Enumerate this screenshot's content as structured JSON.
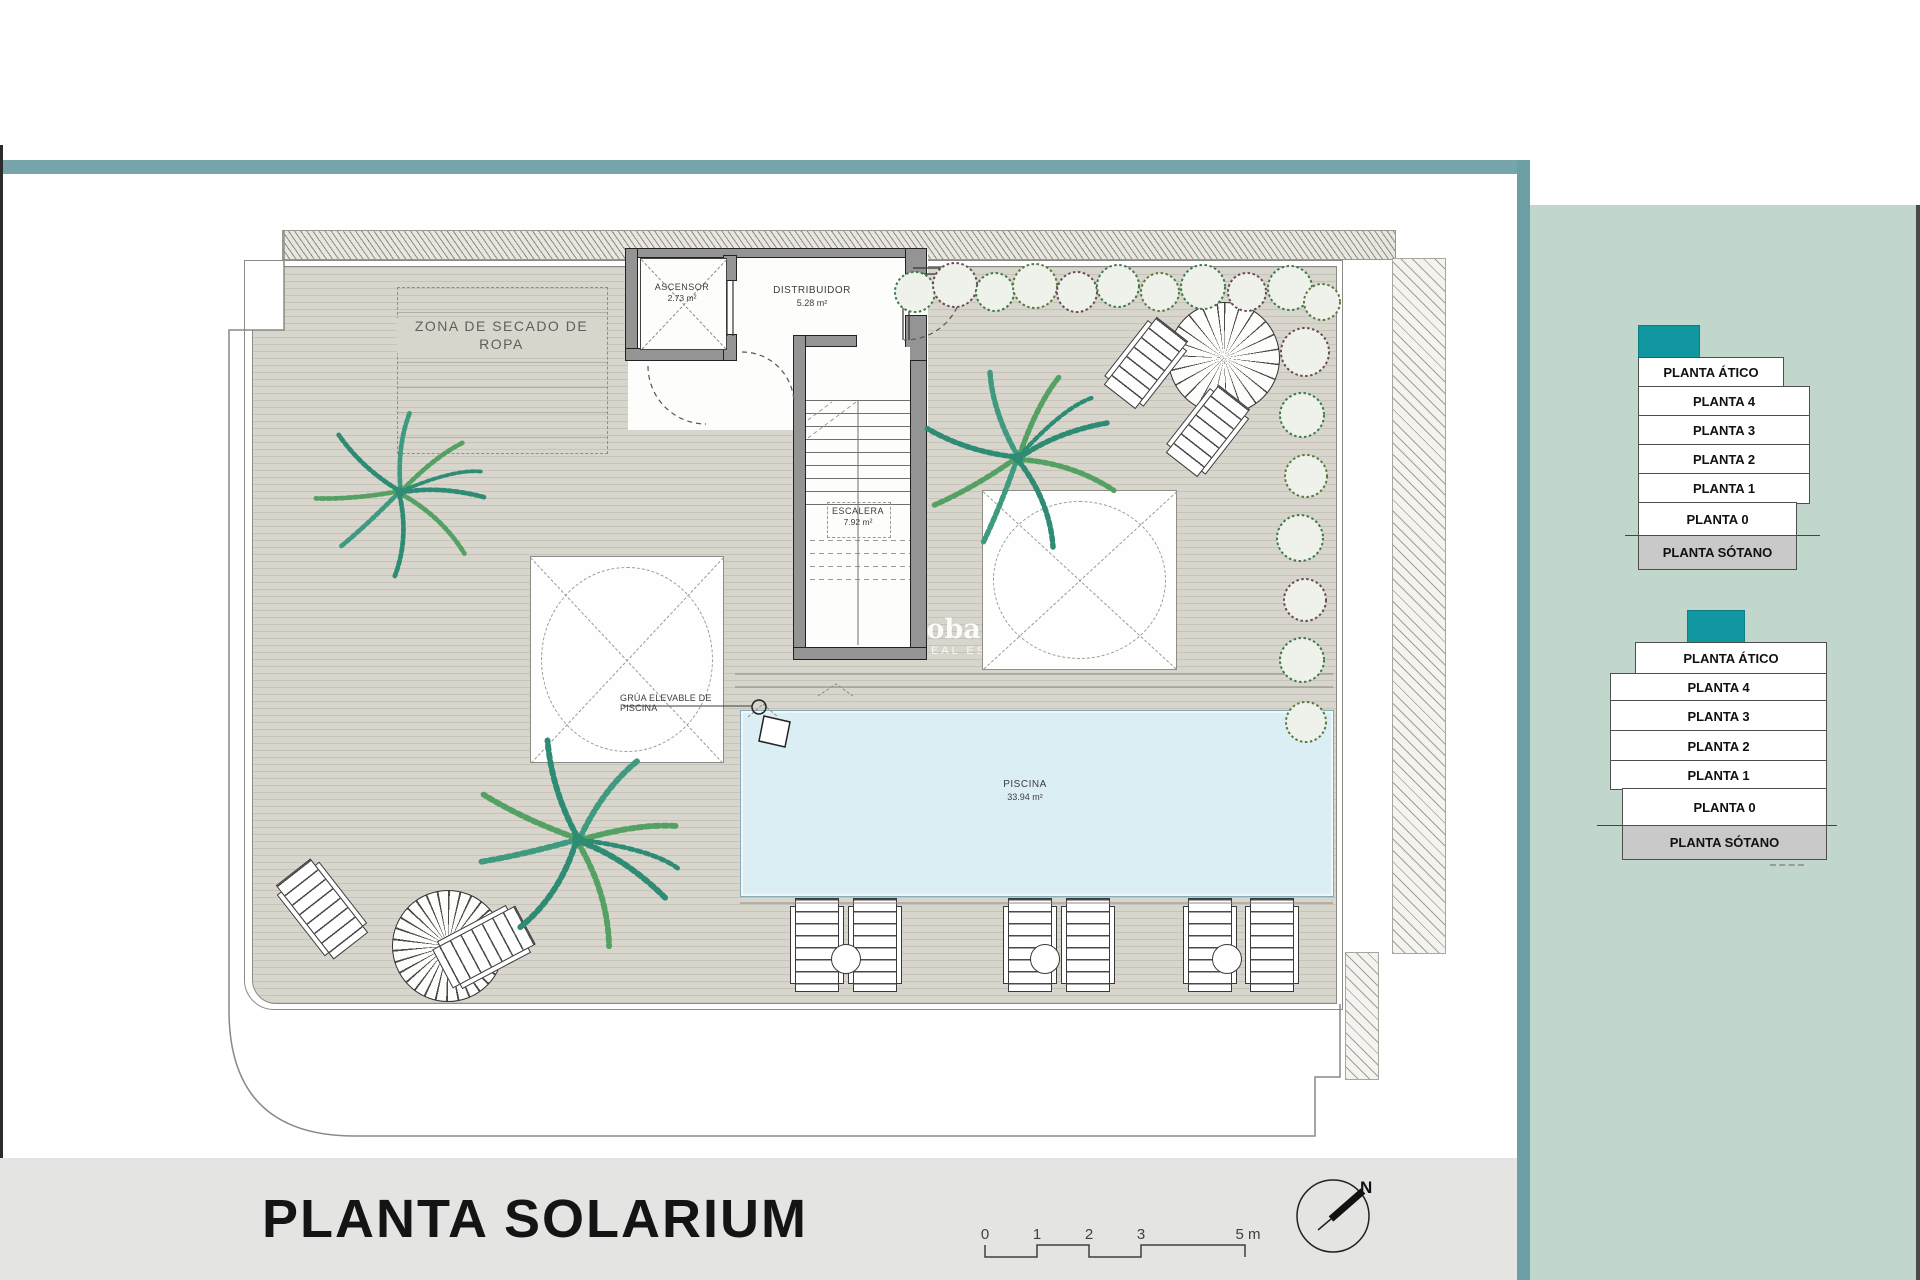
{
  "title": {
    "text": "PLANTA SOLARIUM"
  },
  "plan": {
    "rooms": {
      "ascensor": {
        "name": "ASCENSOR",
        "area": "2.73 m²"
      },
      "distribuidor": {
        "name": "DISTRIBUIDOR",
        "area": "5.28 m²"
      },
      "escalera": {
        "name": "ESCALERA",
        "area": "7.92 m²"
      },
      "piscina": {
        "name": "PISCINA",
        "area": "33.94 m²"
      }
    },
    "labels": {
      "drying_zone": "ZONA DE SECADO DE ROPA",
      "pool_lift": "GRÚA ELEVABLE DE PISCINA"
    },
    "watermark": {
      "brand": "Global S",
      "tagline": "REAL ESTAT"
    }
  },
  "scalebar": {
    "t0": "0",
    "t1": "1",
    "t2": "2",
    "t3": "3",
    "t5": "5 m"
  },
  "compass": {
    "north": "N"
  },
  "stacks": [
    {
      "levels": [
        "PLANTA ÁTICO",
        "PLANTA 4",
        "PLANTA 3",
        "PLANTA 2",
        "PLANTA 1",
        "PLANTA 0",
        "PLANTA SÓTANO"
      ]
    },
    {
      "levels": [
        "PLANTA ÁTICO",
        "PLANTA 4",
        "PLANTA 3",
        "PLANTA 2",
        "PLANTA 1",
        "PLANTA 0",
        "PLANTA SÓTANO"
      ]
    }
  ],
  "colors": {
    "accent_teal": "#1197a0",
    "band_teal": "#76a5ab",
    "sage_background": "#c1d7cc",
    "pool_water": "#daeef4",
    "deck": "#d8d5cc",
    "sotano_gray": "#c9c9c9",
    "title_band_gray": "#e4e4e3"
  }
}
